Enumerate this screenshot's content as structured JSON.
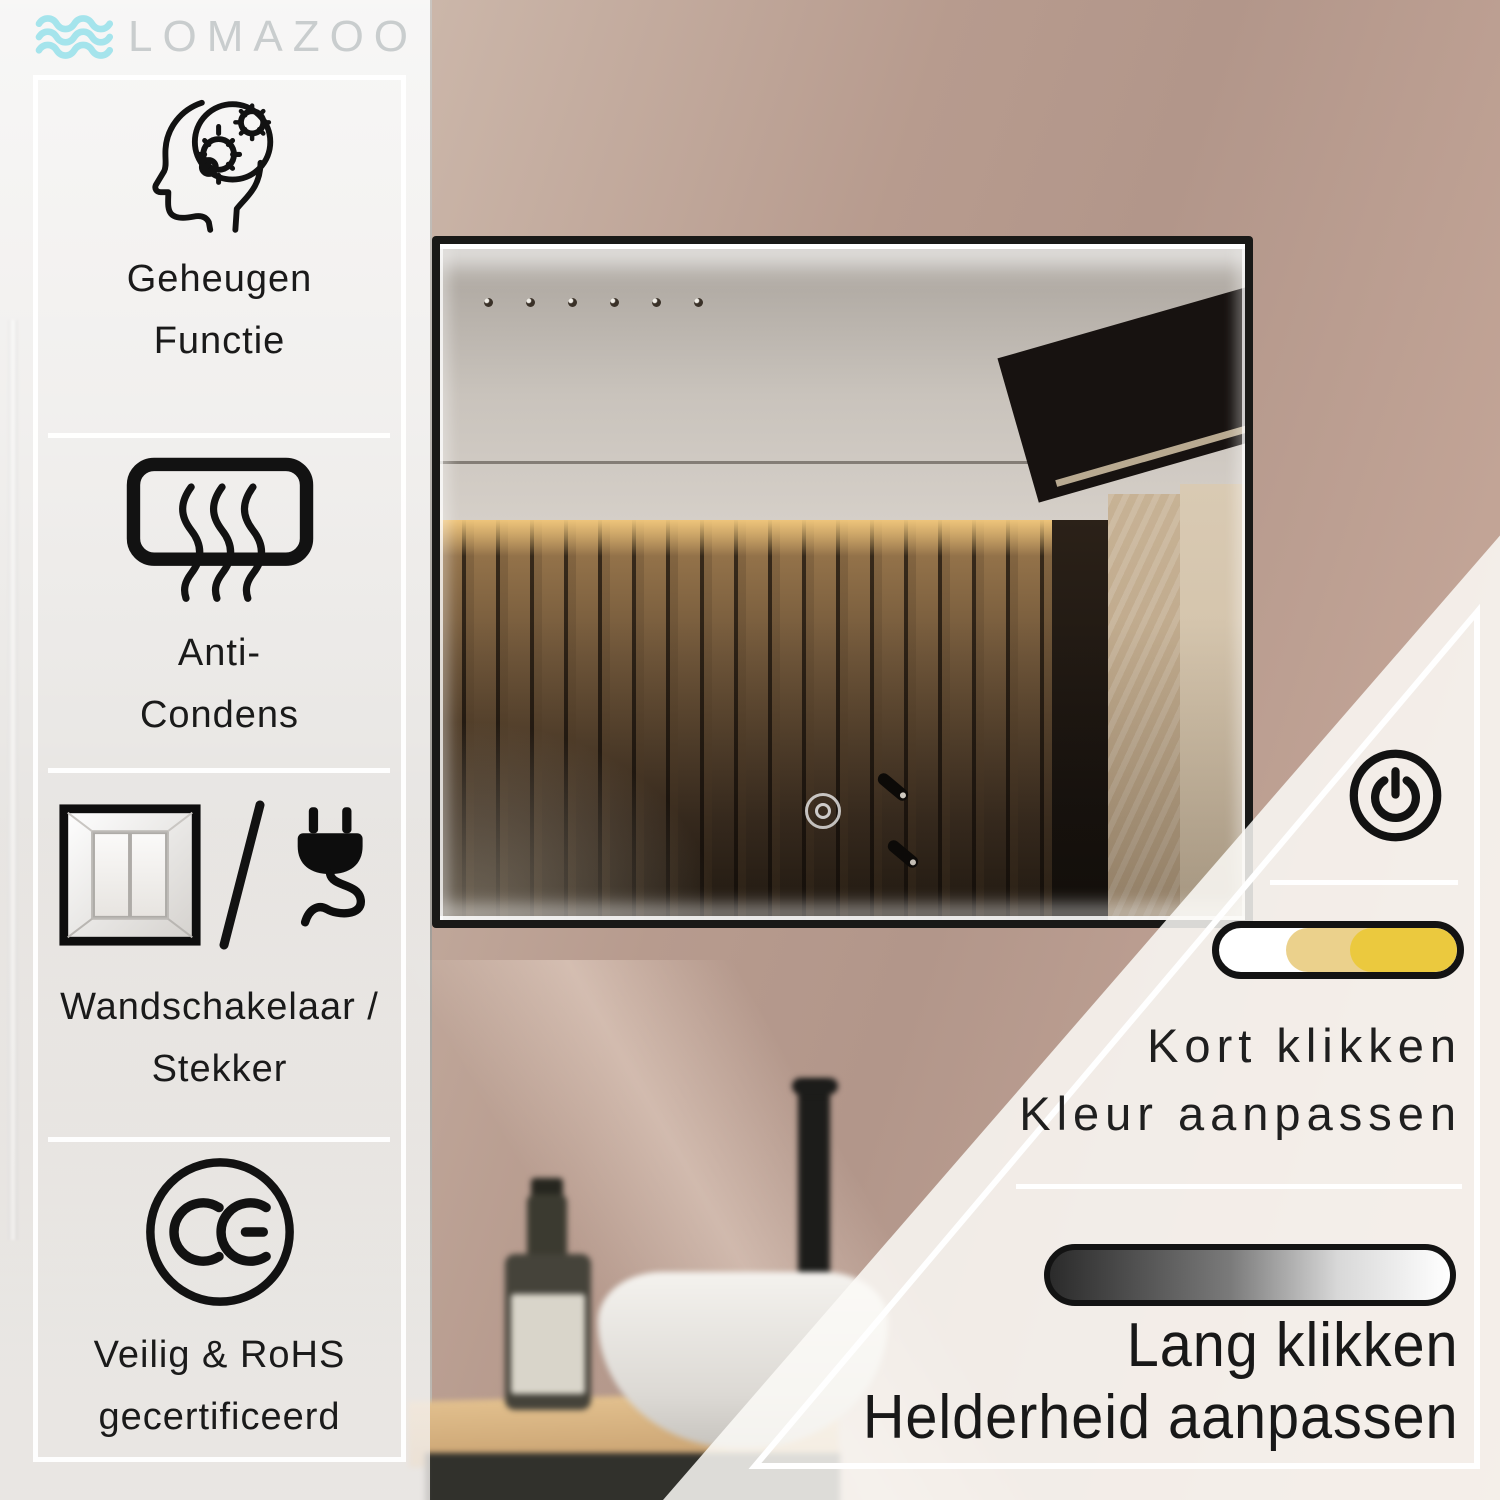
{
  "brand": {
    "name": "LOMAZOO",
    "wave_color": "#A5E4EC",
    "text_color": "#C9CDCE"
  },
  "sidebar": {
    "text_color": "#1A1A1A",
    "features": [
      {
        "icon": "head-gears-icon",
        "lines": [
          "Geheugen",
          "Functie"
        ]
      },
      {
        "icon": "anti-condensation-icon",
        "lines": [
          "Anti-",
          "Condens"
        ]
      },
      {
        "icon": "wall-switch-plug-icon",
        "lines": [
          "Wandschakelaar /",
          "Stekker"
        ]
      },
      {
        "icon": "ce-mark-icon",
        "lines": [
          "Veilig & RoHS",
          "gecertificeerd"
        ]
      }
    ]
  },
  "controls": {
    "power_icon": "power-icon",
    "color_slider": {
      "segment_colors": [
        "#FFFFFF",
        "#EBD18C",
        "#EBC93E"
      ],
      "border_color": "#131313"
    },
    "brightness_bar": {
      "gradient_start": "#2B2B2B",
      "gradient_end": "#FFFFFF",
      "border_color": "#131313"
    },
    "short_click": {
      "lines": [
        "Kort klikken",
        "Kleur aanpassen"
      ]
    },
    "long_click": {
      "lines": [
        "Lang klikken",
        "Helderheid aanpassen"
      ]
    }
  },
  "scene": {
    "wall_color": "#BC9F91",
    "mirror_frame_color": "#191917",
    "led_color": "#FFFFFF"
  }
}
